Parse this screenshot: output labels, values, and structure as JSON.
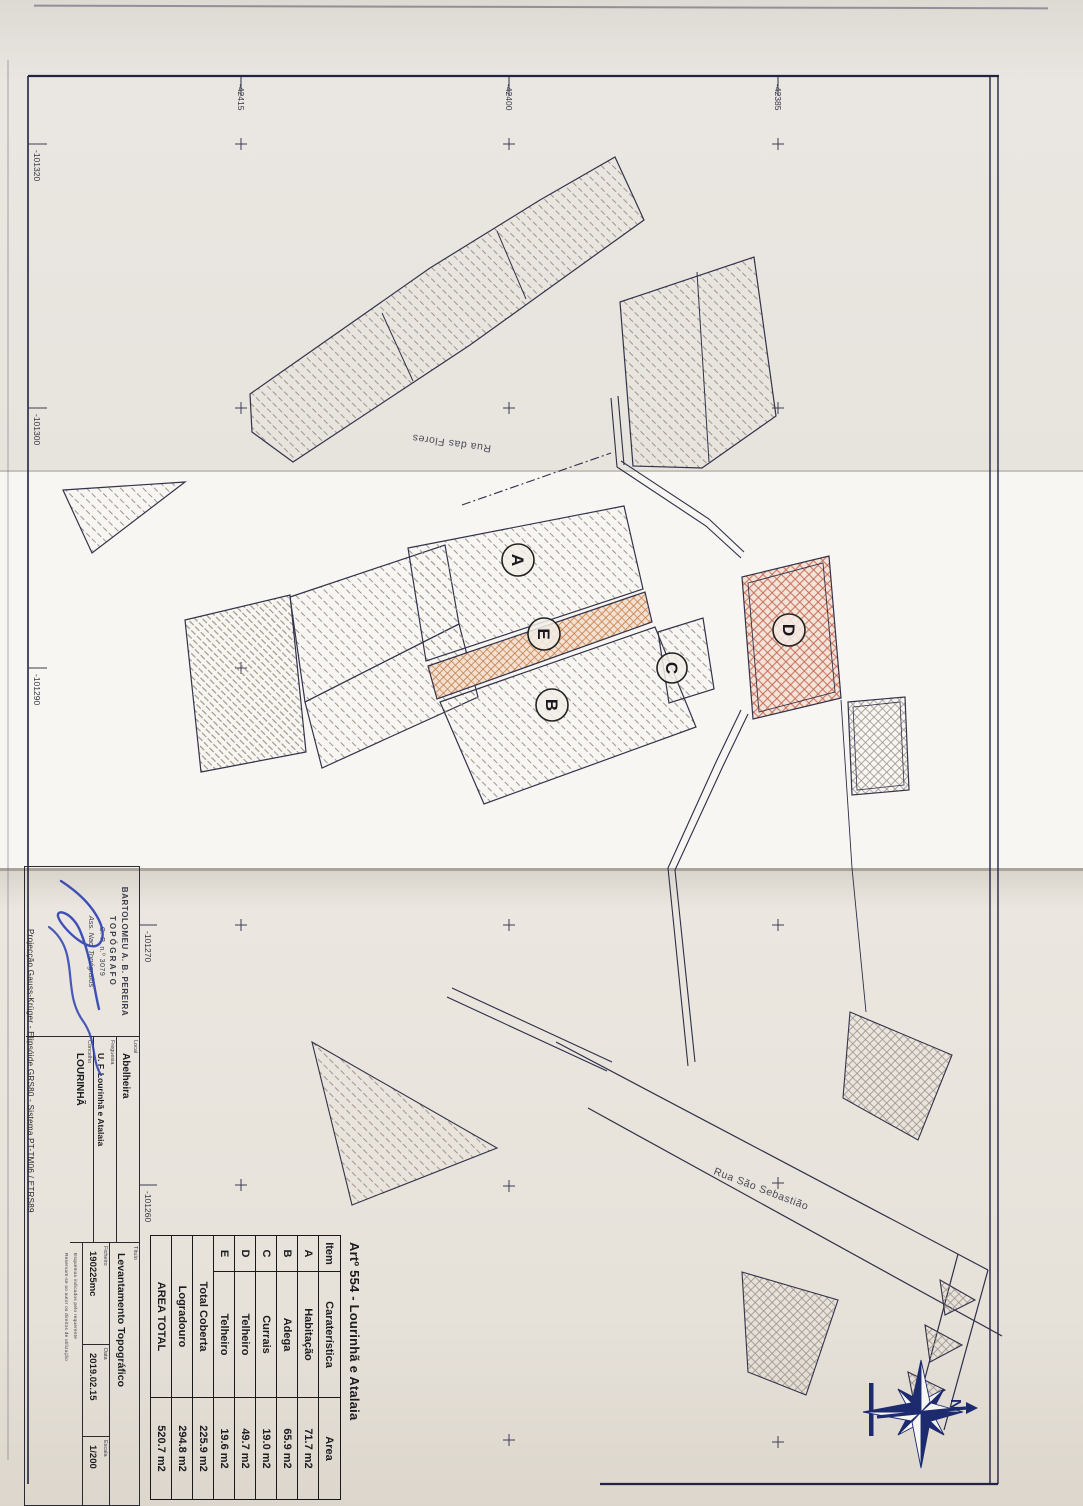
{
  "sheet_title": "Artº 554 - Lourinhã e Atalaia",
  "table": {
    "headers": [
      "Item",
      "Caraterística",
      "Area"
    ],
    "rows": [
      {
        "item": "A",
        "feature": "Habitação",
        "area": "71.7 m2"
      },
      {
        "item": "B",
        "feature": "Adega",
        "area": "65.9 m2"
      },
      {
        "item": "C",
        "feature": "Currais",
        "area": "19.0 m2"
      },
      {
        "item": "D",
        "feature": "Telheiro",
        "area": "49.7 m2"
      },
      {
        "item": "E",
        "feature": "Telheiro",
        "area": "19.6 m2"
      }
    ],
    "summary": [
      {
        "label": "Total Coberta",
        "area": "225.9 m2"
      },
      {
        "label": "Logradouro",
        "area": "294.8 m2"
      },
      {
        "label": "AREA TOTAL",
        "area": "520.7 m2"
      }
    ]
  },
  "title_block": {
    "stamp": {
      "name": "BARTOLOMEU A. B. PEREIRA",
      "role": "TOPÓGRAFO",
      "number": "C. P. n.º 3079",
      "assoc": "Ass. Nac. Topógrafos"
    },
    "projection": "Projecção Gauss-Krüger - Elipsóide GRS80 - Sistema PT-TM06 / ETRS89",
    "fields": {
      "local_label": "Local",
      "local": "Abelheira",
      "freguesia_label": "Freguesia",
      "freguesia": "U. F. Lourinhã e Atalaia",
      "concelho_label": "Concelho",
      "concelho": "LOURINHÃ",
      "titulo_label": "Título",
      "titulo": "Levantamento Topográfico",
      "ficheiro_label": "Ficheiro",
      "ficheiro": "190225mc",
      "data_label": "Data",
      "data": "2019.02.15",
      "escala_label": "Escala",
      "escala": "1/200"
    },
    "notes": [
      "Esquemas indicados pelo requerente",
      "Reservam-se ao autor os direitos de utilização"
    ]
  },
  "map": {
    "streets": [
      "Rua das Flores",
      "Rua São Sebastião"
    ],
    "parcels": [
      "A",
      "B",
      "C",
      "D",
      "E"
    ],
    "north": "N"
  },
  "grid": {
    "top_labels": [
      "-42415",
      "-42400",
      "-42385"
    ],
    "left_labels": [
      "-101320",
      "-101300",
      "-101290",
      "-101270",
      "-101260"
    ]
  },
  "colors": {
    "ink": "#232343",
    "hatch": "#a2938a",
    "hatch_red": "#c2614a",
    "hatch_orange": "#c77a45",
    "signature_blue": "#2b3fb0",
    "compass_navy": "#1d2a6e"
  }
}
